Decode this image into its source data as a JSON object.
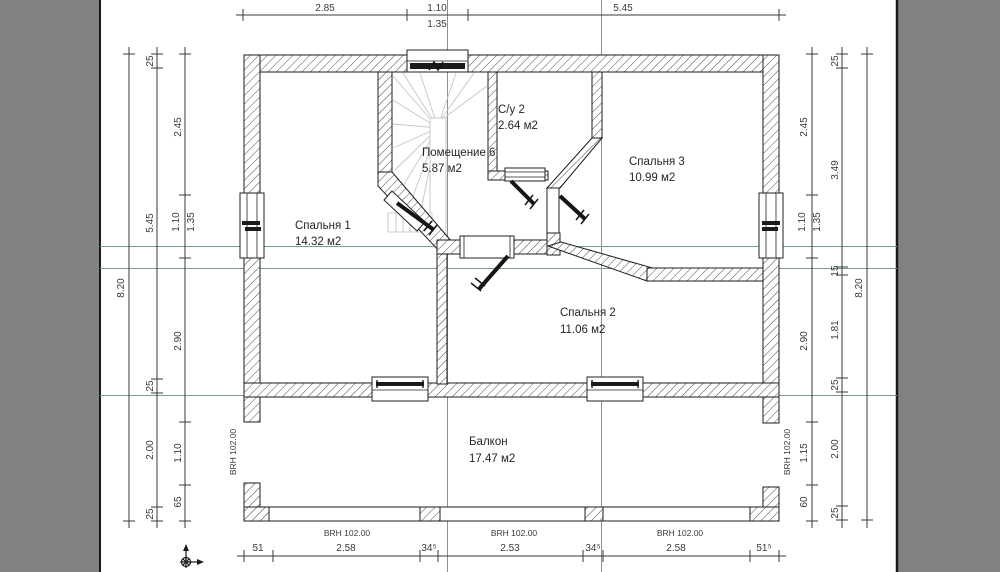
{
  "drawing": {
    "type": "floor-plan",
    "language": "ru"
  },
  "colors": {
    "background": "#828282",
    "paper": "#ffffff",
    "construction_line": "#6FA287",
    "dimension_line": "#3a3a3a",
    "wall_outline": "#1d1d1d",
    "stair_tread": "#c6c6c6",
    "door_leaf": "#151515"
  },
  "rooms": [
    {
      "name": "Спальня 1",
      "area": "14.32 м2"
    },
    {
      "name": "Помещение 6",
      "area": "5.87 м2"
    },
    {
      "name": "С/у 2",
      "area": "2.64 м2"
    },
    {
      "name": "Спальня 3",
      "area": "10.99 м2"
    },
    {
      "name": "Спальня 2",
      "area": "11.06 м2"
    },
    {
      "name": "Балкон",
      "area": "17.47 м2"
    }
  ],
  "dimensions": {
    "top": [
      "2.85",
      "1.10",
      "1.35",
      "5.45"
    ],
    "bottom": [
      "51",
      "2.58",
      "34⁵",
      "2.53",
      "34⁵",
      "2.58",
      "51⁵"
    ],
    "left": {
      "outer": "8.20",
      "middle": [
        "25",
        "5.45",
        "25",
        "2.00",
        "25"
      ],
      "inner": [
        "2.45",
        "1.10",
        "1.35",
        "2.90",
        "1.10",
        "65"
      ]
    },
    "right": {
      "outer": "8.20",
      "middle": [
        "25",
        "3.49",
        "15",
        "1.81",
        "25",
        "2.00",
        "25"
      ],
      "inner": [
        "2.45",
        "1.10",
        "1.35",
        "2.90",
        "1.15",
        "60"
      ]
    }
  },
  "annotations": {
    "parapet_height": "BRH 102.00"
  }
}
